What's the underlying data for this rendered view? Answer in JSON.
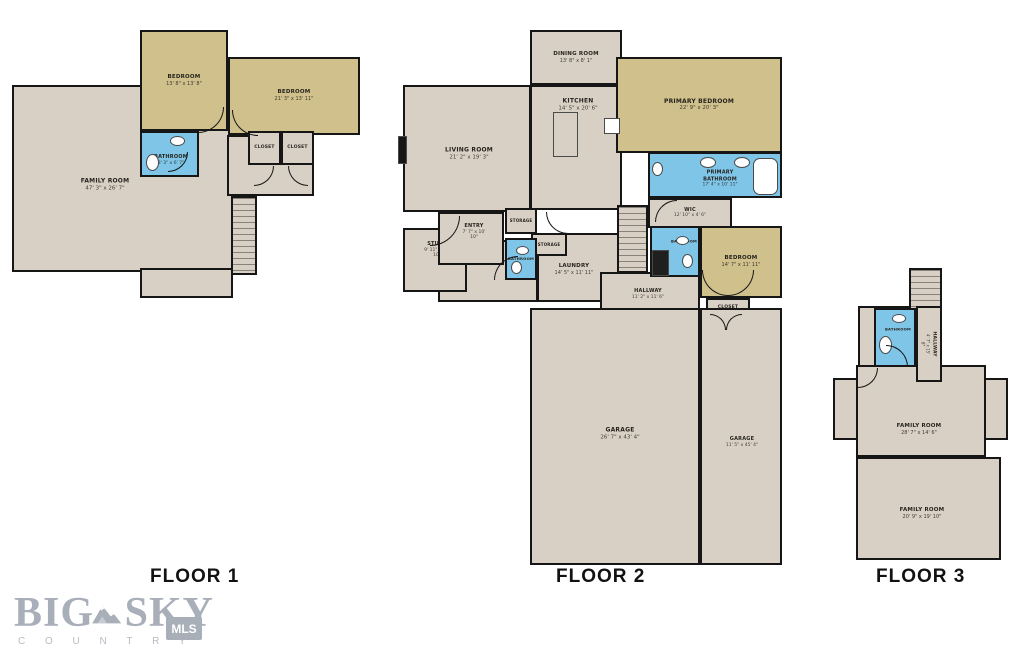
{
  "floorplan": {
    "colors": {
      "floor": "#d9d0c5",
      "bedroom": "#cfc08c",
      "bath": "#7ec5e8",
      "wall": "#161616"
    },
    "floors": [
      {
        "label": "FLOOR 1",
        "rooms": [
          {
            "name": "FAMILY ROOM",
            "dims": "47' 3\" x 26' 7\"",
            "x": 12,
            "y": 85,
            "w": 223,
            "h": 187,
            "fill": "floor",
            "fs": 6,
            "lx": 103,
            "ly": 183
          },
          {
            "x": 140,
            "y": 268,
            "w": 93,
            "h": 30,
            "fill": "floor"
          },
          {
            "x": 227,
            "y": 135,
            "w": 87,
            "h": 61,
            "fill": "floor"
          },
          {
            "stairs": "h",
            "x": 231,
            "y": 196,
            "w": 26,
            "h": 79,
            "fill": "floor"
          },
          {
            "name": "BEDROOM",
            "dims": "13' 8\" x 13' 8\"",
            "x": 140,
            "y": 30,
            "w": 88,
            "h": 101,
            "fill": "bedroom",
            "fs": 5.5
          },
          {
            "name": "BEDROOM",
            "dims": "21' 3\" x 13' 11\"",
            "x": 228,
            "y": 57,
            "w": 132,
            "h": 78,
            "fill": "bedroom",
            "fs": 5.5
          },
          {
            "name": "BATHROOM",
            "dims": "8' 3\" x 6' 7\"",
            "x": 140,
            "y": 131,
            "w": 59,
            "h": 46,
            "fill": "bath",
            "fs": 5,
            "ly": 158,
            "lx": 169
          },
          {
            "name": "CLOSET",
            "x": 248,
            "y": 131,
            "w": 33,
            "h": 34,
            "fill": "floor",
            "fs": 4.5
          },
          {
            "name": "CLOSET",
            "x": 281,
            "y": 131,
            "w": 33,
            "h": 34,
            "fill": "floor",
            "fs": 4.5
          }
        ]
      },
      {
        "label": "FLOOR 2",
        "rooms": [
          {
            "name": "LIVING ROOM",
            "dims": "21' 2\" x 19' 3\"",
            "x": 403,
            "y": 85,
            "w": 128,
            "h": 127,
            "fill": "floor",
            "fs": 6,
            "lx": 467,
            "ly": 152
          },
          {
            "name": "DINING ROOM",
            "dims": "13' 8\" x 8' 1\"",
            "x": 530,
            "y": 30,
            "w": 92,
            "h": 55,
            "fill": "floor",
            "fs": 5.5
          },
          {
            "name": "KITCHEN",
            "dims": "14' 5\" x 20' 6\"",
            "x": 530,
            "y": 85,
            "w": 92,
            "h": 125,
            "fill": "floor",
            "fs": 6,
            "lx": 576,
            "ly": 103
          },
          {
            "name": "PRIMARY BEDROOM",
            "dims": "22' 9\" x 20' 3\"",
            "x": 616,
            "y": 57,
            "w": 166,
            "h": 96,
            "fill": "bedroom",
            "fs": 6
          },
          {
            "name": "PRIMARY BATHROOM",
            "dims": "17' 4\" x 10' 11\"",
            "x": 648,
            "y": 152,
            "w": 134,
            "h": 46,
            "fill": "bath",
            "fs": 5,
            "lx": 718,
            "ly": 177
          },
          {
            "name": "WIC",
            "dims": "12' 10\" x 4' 6\"",
            "x": 648,
            "y": 198,
            "w": 84,
            "h": 30,
            "fill": "floor",
            "fs": 5
          },
          {
            "x": 438,
            "y": 240,
            "w": 100,
            "h": 62,
            "fill": "floor"
          },
          {
            "name": "STUDY",
            "dims": "9' 11\" x 16' 10\"",
            "x": 403,
            "y": 228,
            "w": 64,
            "h": 64,
            "fill": "floor",
            "fs": 5,
            "lx": 435,
            "ly": 248
          },
          {
            "name": "ENTRY",
            "dims": "7' 7\" x 10' 10\"",
            "x": 438,
            "y": 212,
            "w": 66,
            "h": 53,
            "fill": "floor",
            "fs": 5,
            "lx": 472,
            "ly": 230
          },
          {
            "name": "LAUNDRY",
            "dims": "14' 5\" x 11' 11\"",
            "x": 537,
            "y": 233,
            "w": 85,
            "h": 69,
            "fill": "floor",
            "fs": 5.5,
            "lx": 572,
            "ly": 268
          },
          {
            "name": "STORAGE",
            "x": 505,
            "y": 208,
            "w": 32,
            "h": 26,
            "fill": "floor",
            "fs": 4
          },
          {
            "name": "STORAGE",
            "x": 531,
            "y": 233,
            "w": 36,
            "h": 23,
            "fill": "floor",
            "fs": 4
          },
          {
            "name": "BATHROOM",
            "x": 505,
            "y": 238,
            "w": 32,
            "h": 42,
            "fill": "bath",
            "fs": 3.8
          },
          {
            "stairs": "h",
            "x": 617,
            "y": 205,
            "w": 31,
            "h": 68,
            "fill": "floor"
          },
          {
            "name": "HALLWAY",
            "dims": "11' 2\" x 11' 6\"",
            "x": 600,
            "y": 272,
            "w": 100,
            "h": 38,
            "fill": "floor",
            "fs": 5,
            "lx": 646,
            "ly": 292
          },
          {
            "name": "BATHROOM",
            "x": 650,
            "y": 226,
            "w": 50,
            "h": 51,
            "fill": "bath",
            "fs": 3.8,
            "lx": 682,
            "ly": 240
          },
          {
            "name": "BEDROOM",
            "dims": "14' 7\" x 11' 11\"",
            "x": 700,
            "y": 226,
            "w": 82,
            "h": 72,
            "fill": "bedroom",
            "fs": 5.5
          },
          {
            "name": "CLOSET",
            "x": 706,
            "y": 298,
            "w": 44,
            "h": 20,
            "fill": "floor",
            "fs": 4.5
          },
          {
            "name": "GARAGE",
            "dims": "26' 7\" x 43' 4\"",
            "x": 530,
            "y": 308,
            "w": 170,
            "h": 257,
            "fill": "floor",
            "fs": 6,
            "lx": 618,
            "ly": 432
          },
          {
            "name": "GARAGE",
            "dims": "11' 5\" x 45' 4\"",
            "x": 700,
            "y": 308,
            "w": 82,
            "h": 257,
            "fill": "floor",
            "fs": 5,
            "lx": 740,
            "ly": 440
          }
        ]
      },
      {
        "label": "FLOOR 3",
        "rooms": [
          {
            "x": 858,
            "y": 306,
            "w": 84,
            "h": 62,
            "fill": "floor"
          },
          {
            "stairs": "h",
            "x": 909,
            "y": 268,
            "w": 33,
            "h": 44,
            "fill": "floor"
          },
          {
            "x": 833,
            "y": 378,
            "w": 26,
            "h": 62,
            "fill": "floor"
          },
          {
            "x": 984,
            "y": 378,
            "w": 24,
            "h": 62,
            "fill": "floor"
          },
          {
            "name": "FAMILY ROOM",
            "dims": "28' 7\" x 14' 6\"",
            "x": 856,
            "y": 365,
            "w": 130,
            "h": 92,
            "fill": "floor",
            "fs": 5.5,
            "lx": 917,
            "ly": 428
          },
          {
            "name": "FAMILY ROOM",
            "dims": "20' 9\" x 19' 10\"",
            "x": 856,
            "y": 457,
            "w": 145,
            "h": 103,
            "fill": "floor",
            "fs": 5.5,
            "lx": 920,
            "ly": 512
          },
          {
            "name": "BATHROOM",
            "x": 874,
            "y": 308,
            "w": 42,
            "h": 59,
            "fill": "bath",
            "fs": 3.8,
            "lx": 896,
            "ly": 328
          },
          {
            "name": "HALLWAY",
            "dims": "4' 7\" x 15' 8\"",
            "x": 916,
            "y": 306,
            "w": 26,
            "h": 76,
            "fill": "floor",
            "fs": 4.5,
            "vert": true
          }
        ]
      }
    ],
    "doors": [
      {
        "x": 198,
        "y": 107,
        "s": 26,
        "c": "br"
      },
      {
        "x": 232,
        "y": 110,
        "s": 26,
        "c": "bl"
      },
      {
        "x": 168,
        "y": 152,
        "s": 20,
        "c": "br"
      },
      {
        "x": 254,
        "y": 166,
        "s": 20,
        "c": "br"
      },
      {
        "x": 288,
        "y": 166,
        "s": 20,
        "c": "bl"
      },
      {
        "x": 430,
        "y": 216,
        "s": 30,
        "c": "br"
      },
      {
        "x": 494,
        "y": 256,
        "s": 24,
        "c": "tl"
      },
      {
        "x": 546,
        "y": 212,
        "s": 22,
        "c": "bl"
      },
      {
        "x": 655,
        "y": 200,
        "s": 22,
        "c": "tl"
      },
      {
        "x": 702,
        "y": 270,
        "s": 26,
        "c": "bl"
      },
      {
        "x": 728,
        "y": 270,
        "s": 26,
        "c": "br"
      },
      {
        "x": 710,
        "y": 314,
        "s": 16,
        "c": "tr"
      },
      {
        "x": 726,
        "y": 314,
        "s": 16,
        "c": "tl"
      },
      {
        "x": 886,
        "y": 345,
        "s": 22,
        "c": "tr"
      },
      {
        "x": 858,
        "y": 368,
        "s": 20,
        "c": "br"
      }
    ],
    "fixtures": [
      {
        "n": "toilet",
        "t": "e",
        "x": 146,
        "y": 154,
        "w": 13,
        "h": 17
      },
      {
        "n": "sink",
        "t": "e",
        "x": 170,
        "y": 136,
        "w": 15,
        "h": 10
      },
      {
        "n": "sink",
        "t": "e",
        "x": 700,
        "y": 157,
        "w": 16,
        "h": 11
      },
      {
        "n": "sink",
        "t": "e",
        "x": 734,
        "y": 157,
        "w": 16,
        "h": 11
      },
      {
        "n": "bathtub",
        "t": "r",
        "x": 753,
        "y": 158,
        "w": 25,
        "h": 37,
        "rnd": 7
      },
      {
        "n": "toilet",
        "t": "e",
        "x": 652,
        "y": 162,
        "w": 11,
        "h": 14
      },
      {
        "n": "sink",
        "t": "e",
        "x": 516,
        "y": 246,
        "w": 13,
        "h": 9
      },
      {
        "n": "toilet",
        "t": "e",
        "x": 511,
        "y": 261,
        "w": 11,
        "h": 13
      },
      {
        "n": "sink",
        "t": "e",
        "x": 676,
        "y": 236,
        "w": 13,
        "h": 9
      },
      {
        "n": "shower",
        "t": "r",
        "x": 652,
        "y": 250,
        "w": 17,
        "h": 26,
        "color": "#1f1f1f"
      },
      {
        "n": "toilet",
        "t": "e",
        "x": 682,
        "y": 254,
        "w": 11,
        "h": 14
      },
      {
        "n": "toilet",
        "t": "e",
        "x": 879,
        "y": 336,
        "w": 13,
        "h": 18
      },
      {
        "n": "sink",
        "t": "e",
        "x": 892,
        "y": 314,
        "w": 14,
        "h": 9
      },
      {
        "n": "kitchen-island",
        "t": "r",
        "x": 553,
        "y": 112,
        "w": 25,
        "h": 45,
        "color": "#d9d0c5"
      },
      {
        "n": "stove",
        "t": "r",
        "x": 604,
        "y": 118,
        "w": 16,
        "h": 16
      },
      {
        "n": "fireplace",
        "t": "r",
        "x": 398,
        "y": 136,
        "w": 9,
        "h": 28,
        "color": "#161616"
      }
    ]
  },
  "logo": {
    "big": "BIG",
    "sky": "SKY",
    "country": "C O U N T R Y",
    "mls": "MLS"
  }
}
